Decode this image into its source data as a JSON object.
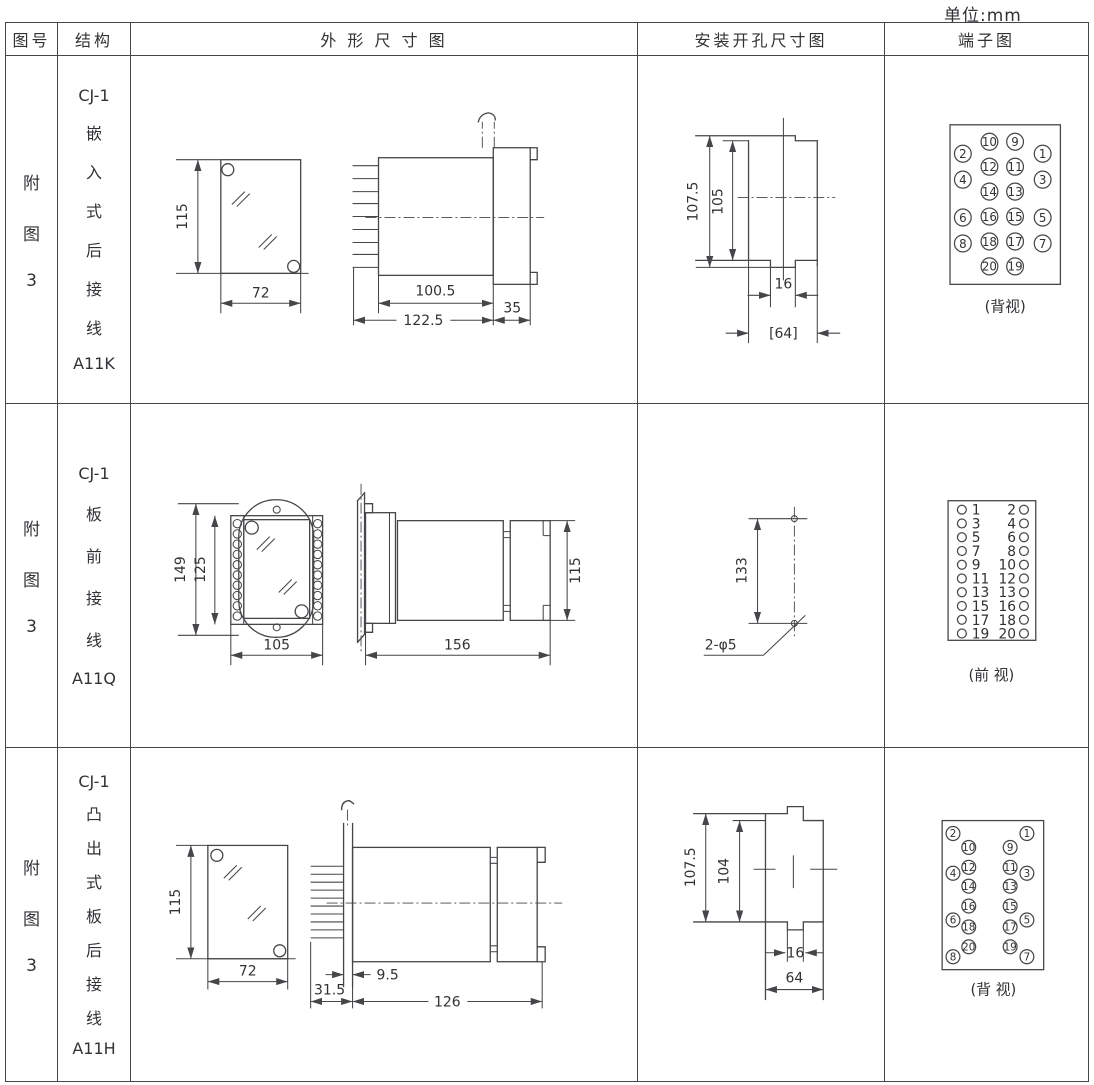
{
  "unit_label": "单位:mm",
  "header": [
    "图号",
    "结构",
    "外 形 尺 寸 图",
    "安装开孔尺寸图",
    "端子图"
  ],
  "rows": [
    {
      "figure_no": [
        "附",
        "图",
        "3"
      ],
      "structure": [
        "CJ-1",
        "嵌",
        "入",
        "式",
        "后",
        "接",
        "线",
        "A11K"
      ],
      "outline": {
        "height": "115",
        "width": "72",
        "body_len": "100.5",
        "total_len": "122.5",
        "flange": "35"
      },
      "install": {
        "outer_h": "107.5",
        "inner_h": "105",
        "notch_w": "16",
        "slot_w": "[64]"
      },
      "terminal": {
        "view": "(背视)",
        "mid_rows": [
          [
            "10",
            "9"
          ],
          [
            "12",
            "11"
          ],
          [
            "14",
            "13"
          ],
          [
            "16",
            "15"
          ],
          [
            "18",
            "17"
          ],
          [
            "20",
            "19"
          ]
        ],
        "outer_left": [
          "2",
          "4",
          "6",
          "8"
        ],
        "outer_right": [
          "1",
          "3",
          "5",
          "7"
        ]
      }
    },
    {
      "figure_no": [
        "附",
        "图",
        "3"
      ],
      "structure": [
        "CJ-1",
        "板",
        "前",
        "接",
        "线",
        "A11Q"
      ],
      "outline": {
        "plate_h": "149",
        "case_h": "125",
        "width": "105",
        "length": "156",
        "side_h": "115"
      },
      "install": {
        "hole_span": "133",
        "holes": "2-φ5"
      },
      "terminal": {
        "view": "(前 视)",
        "rows": [
          [
            "1",
            "2"
          ],
          [
            "3",
            "4"
          ],
          [
            "5",
            "6"
          ],
          [
            "7",
            "8"
          ],
          [
            "9",
            "10"
          ],
          [
            "11",
            "12"
          ],
          [
            "13",
            "13"
          ],
          [
            "15",
            "16"
          ],
          [
            "17",
            "18"
          ],
          [
            "19",
            "20"
          ]
        ]
      }
    },
    {
      "figure_no": [
        "附",
        "图",
        "3"
      ],
      "structure": [
        "CJ-1",
        "凸",
        "出",
        "式",
        "板",
        "后",
        "接",
        "线",
        "A11H"
      ],
      "outline": {
        "height": "115",
        "width": "72",
        "flange": "9.5",
        "front_len": "31.5",
        "body_len": "126"
      },
      "install": {
        "outer_h": "107.5",
        "inner_h": "104",
        "notch_w": "16",
        "slot_w": "64"
      },
      "terminal": {
        "view": "(背 视)",
        "corners": [
          "2",
          "1",
          "8",
          "7"
        ],
        "mid_left": [
          "10",
          "12",
          "14",
          "16",
          "18",
          "20"
        ],
        "mid_right": [
          "9",
          "11",
          "13",
          "15",
          "17",
          "19"
        ],
        "outer_left": [
          "4",
          "6"
        ],
        "outer_right": [
          "3",
          "5"
        ]
      }
    }
  ]
}
